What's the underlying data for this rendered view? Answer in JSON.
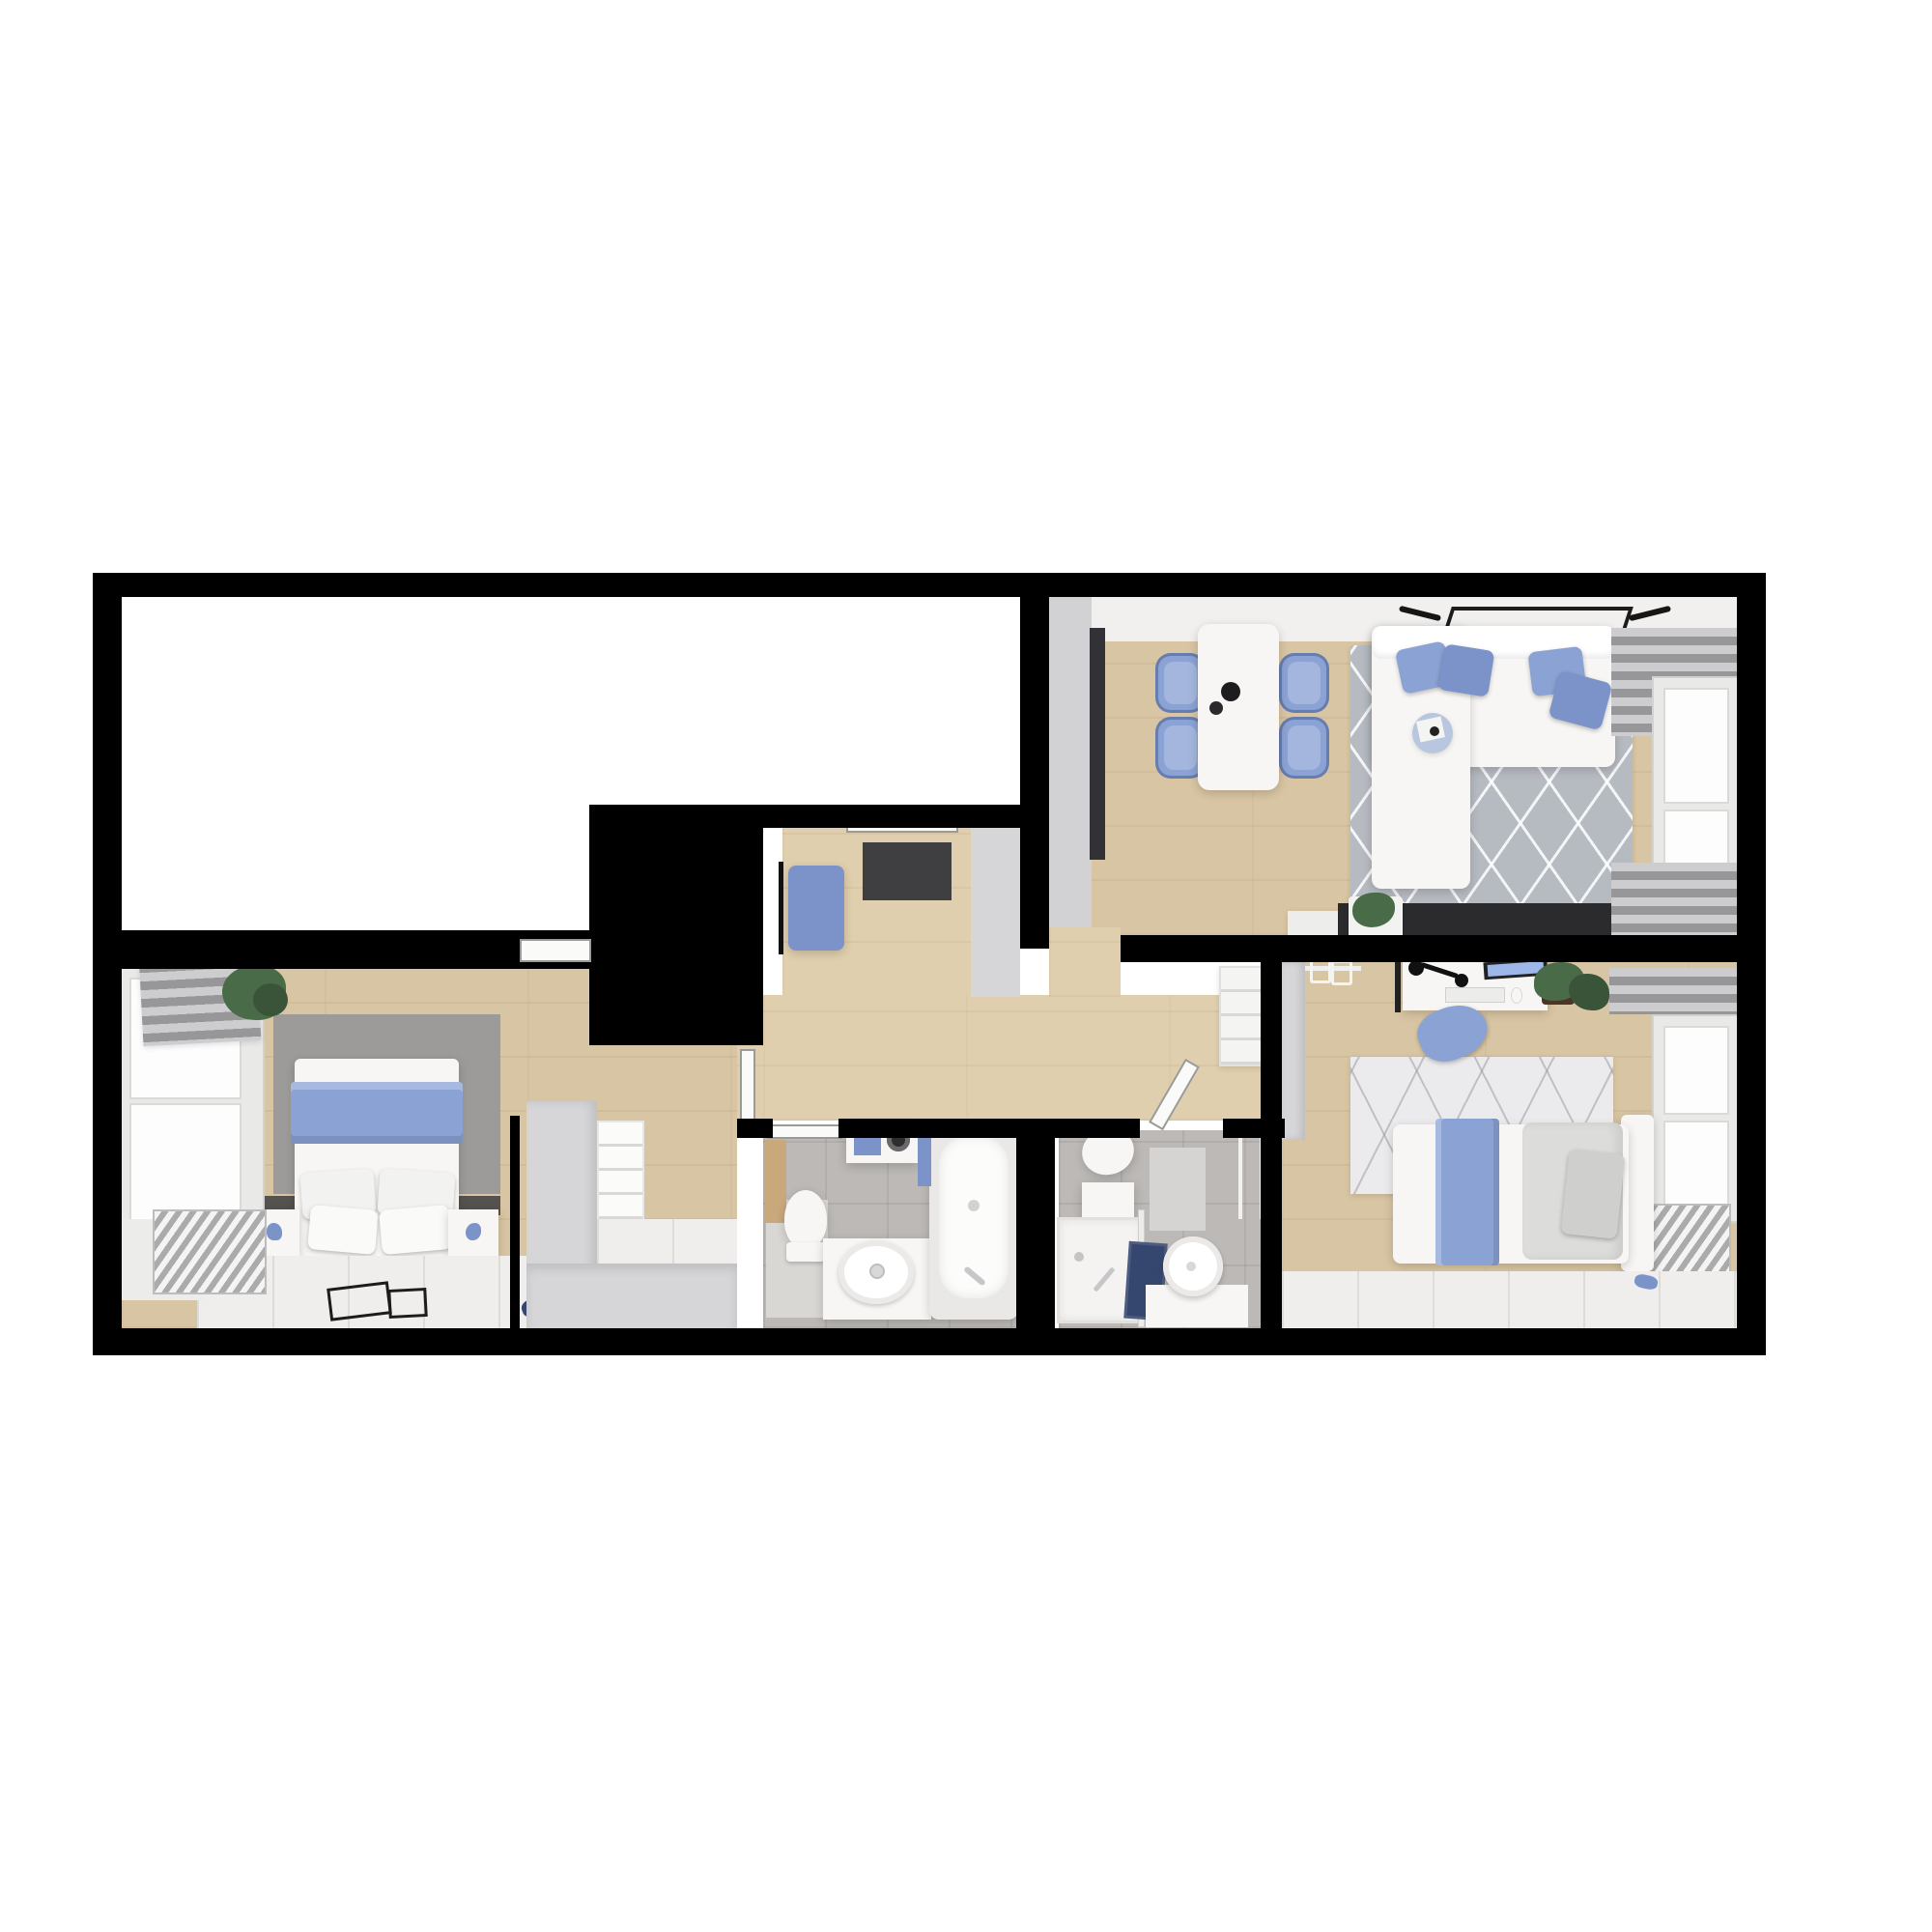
{
  "scene": {
    "type": "3d-floor-plan-render",
    "view": "top-down-birdseye",
    "background": "#ffffff",
    "style": "photoreal render, white/blue scandinavian interior, black wall cut"
  },
  "palette": {
    "wall_black": "#000000",
    "wood": "#d8c5a3",
    "wood_light": "#e0cfae",
    "wall_face_grey": "#d2d2d4",
    "white_room": "#ffffff",
    "wall_band_white": "#f1f0ee",
    "charcoal": "#323236",
    "console_black": "#2b2b2e",
    "doormat": "#3f3f42",
    "accent_blue": "#8ba2d4",
    "accent_blue_deep": "#7b93c8",
    "navy": "#35466f",
    "rug_living": "#b6bbc1",
    "rug_bedroom1": "#9c9b99",
    "rug_bedroom2": "#ebebed",
    "bath_floor": "#bcb9b6",
    "bath_floor_light": "#d9d7d4",
    "fixture_white": "#f7f6f4",
    "platform_white": "#efeeec",
    "curtain_grey": "#b4b4b6",
    "plant_green": "#4a6b47",
    "plant_green_dark": "#3a543a",
    "headboard_dark": "#56524f",
    "wood_shelf_tan": "#c9a87c",
    "grey_unit": "#d6d6d8",
    "screen_blue": "#9db8e8",
    "chrome": "#c7c7c9"
  },
  "rooms": [
    {
      "id": "unfurnished-room",
      "name": "empty white room (top-left)",
      "furniture": []
    },
    {
      "id": "living-dining",
      "name": "living / dining room (top-right)",
      "furniture": [
        "kitchen tall unit (charcoal)",
        "dining table (white)",
        "dining chair (blue) x4",
        "table vases x2",
        "corner sofa (white)",
        "sofa cushion (blue) x4",
        "round side table",
        "area rug (grey, diamond lines)",
        "wall TV",
        "wall lamp x2",
        "media console (black)",
        "potted plant",
        "sideboard (white)",
        "curtains (grey) x2",
        "window"
      ]
    },
    {
      "id": "entry-hall",
      "name": "entry hall",
      "furniture": [
        "bench (blue)",
        "coat rack (black)",
        "doormat (charcoal)",
        "front door",
        "closet block (grey)"
      ]
    },
    {
      "id": "corridor",
      "name": "corridor",
      "furniture": [
        "shelf unit (white)",
        "open door to shower room",
        "open door to bathroom"
      ]
    },
    {
      "id": "bedroom-1",
      "name": "master bedroom (bottom-left)",
      "furniture": [
        "double bed (white)",
        "throw blanket (blue)",
        "pillow x4",
        "nightstand x2",
        "area rug (grey)",
        "roman blind (grey)",
        "window",
        "radiator",
        "potted plant",
        "platform floor (white)",
        "picture frames (black outline) x2",
        "slippers (blue)",
        "walk-in closet: wardrobe L-unit (grey) + shelving (white)"
      ]
    },
    {
      "id": "bathroom-1",
      "name": "bathroom with tub (bottom-centre)",
      "furniture": [
        "toilet",
        "washbasin vanity",
        "bathtub",
        "towel (blue)",
        "washer cabinet with towels",
        "wooden shelf"
      ]
    },
    {
      "id": "bathroom-2",
      "name": "shower room",
      "furniture": [
        "toilet",
        "cabinet (white)",
        "shower tray",
        "glass screen",
        "towels (navy)",
        "round washbasin on counter",
        "towel rail",
        "bath mat (grey)"
      ]
    },
    {
      "id": "bedroom-2",
      "name": "second bedroom / office (bottom-right)",
      "furniture": [
        "single bed (white)",
        "blanket (blue)",
        "duvet (grey)",
        "pillow (grey)",
        "desk (white)",
        "monitor",
        "keyboard",
        "mouse",
        "desk lamp (black)",
        "desk chair (blue)",
        "potted plant",
        "open wardrobe with hangers",
        "area rug (white, line pattern)",
        "radiator",
        "window",
        "curtains (grey)",
        "platform floor (white)",
        "slippers (blue)"
      ]
    }
  ],
  "counts": {
    "dining_chairs": 4,
    "sofa_cushions": 4,
    "bathrooms": 2,
    "bedrooms": 2,
    "windows_right_wall": 2,
    "windows_left_wall": 1
  }
}
